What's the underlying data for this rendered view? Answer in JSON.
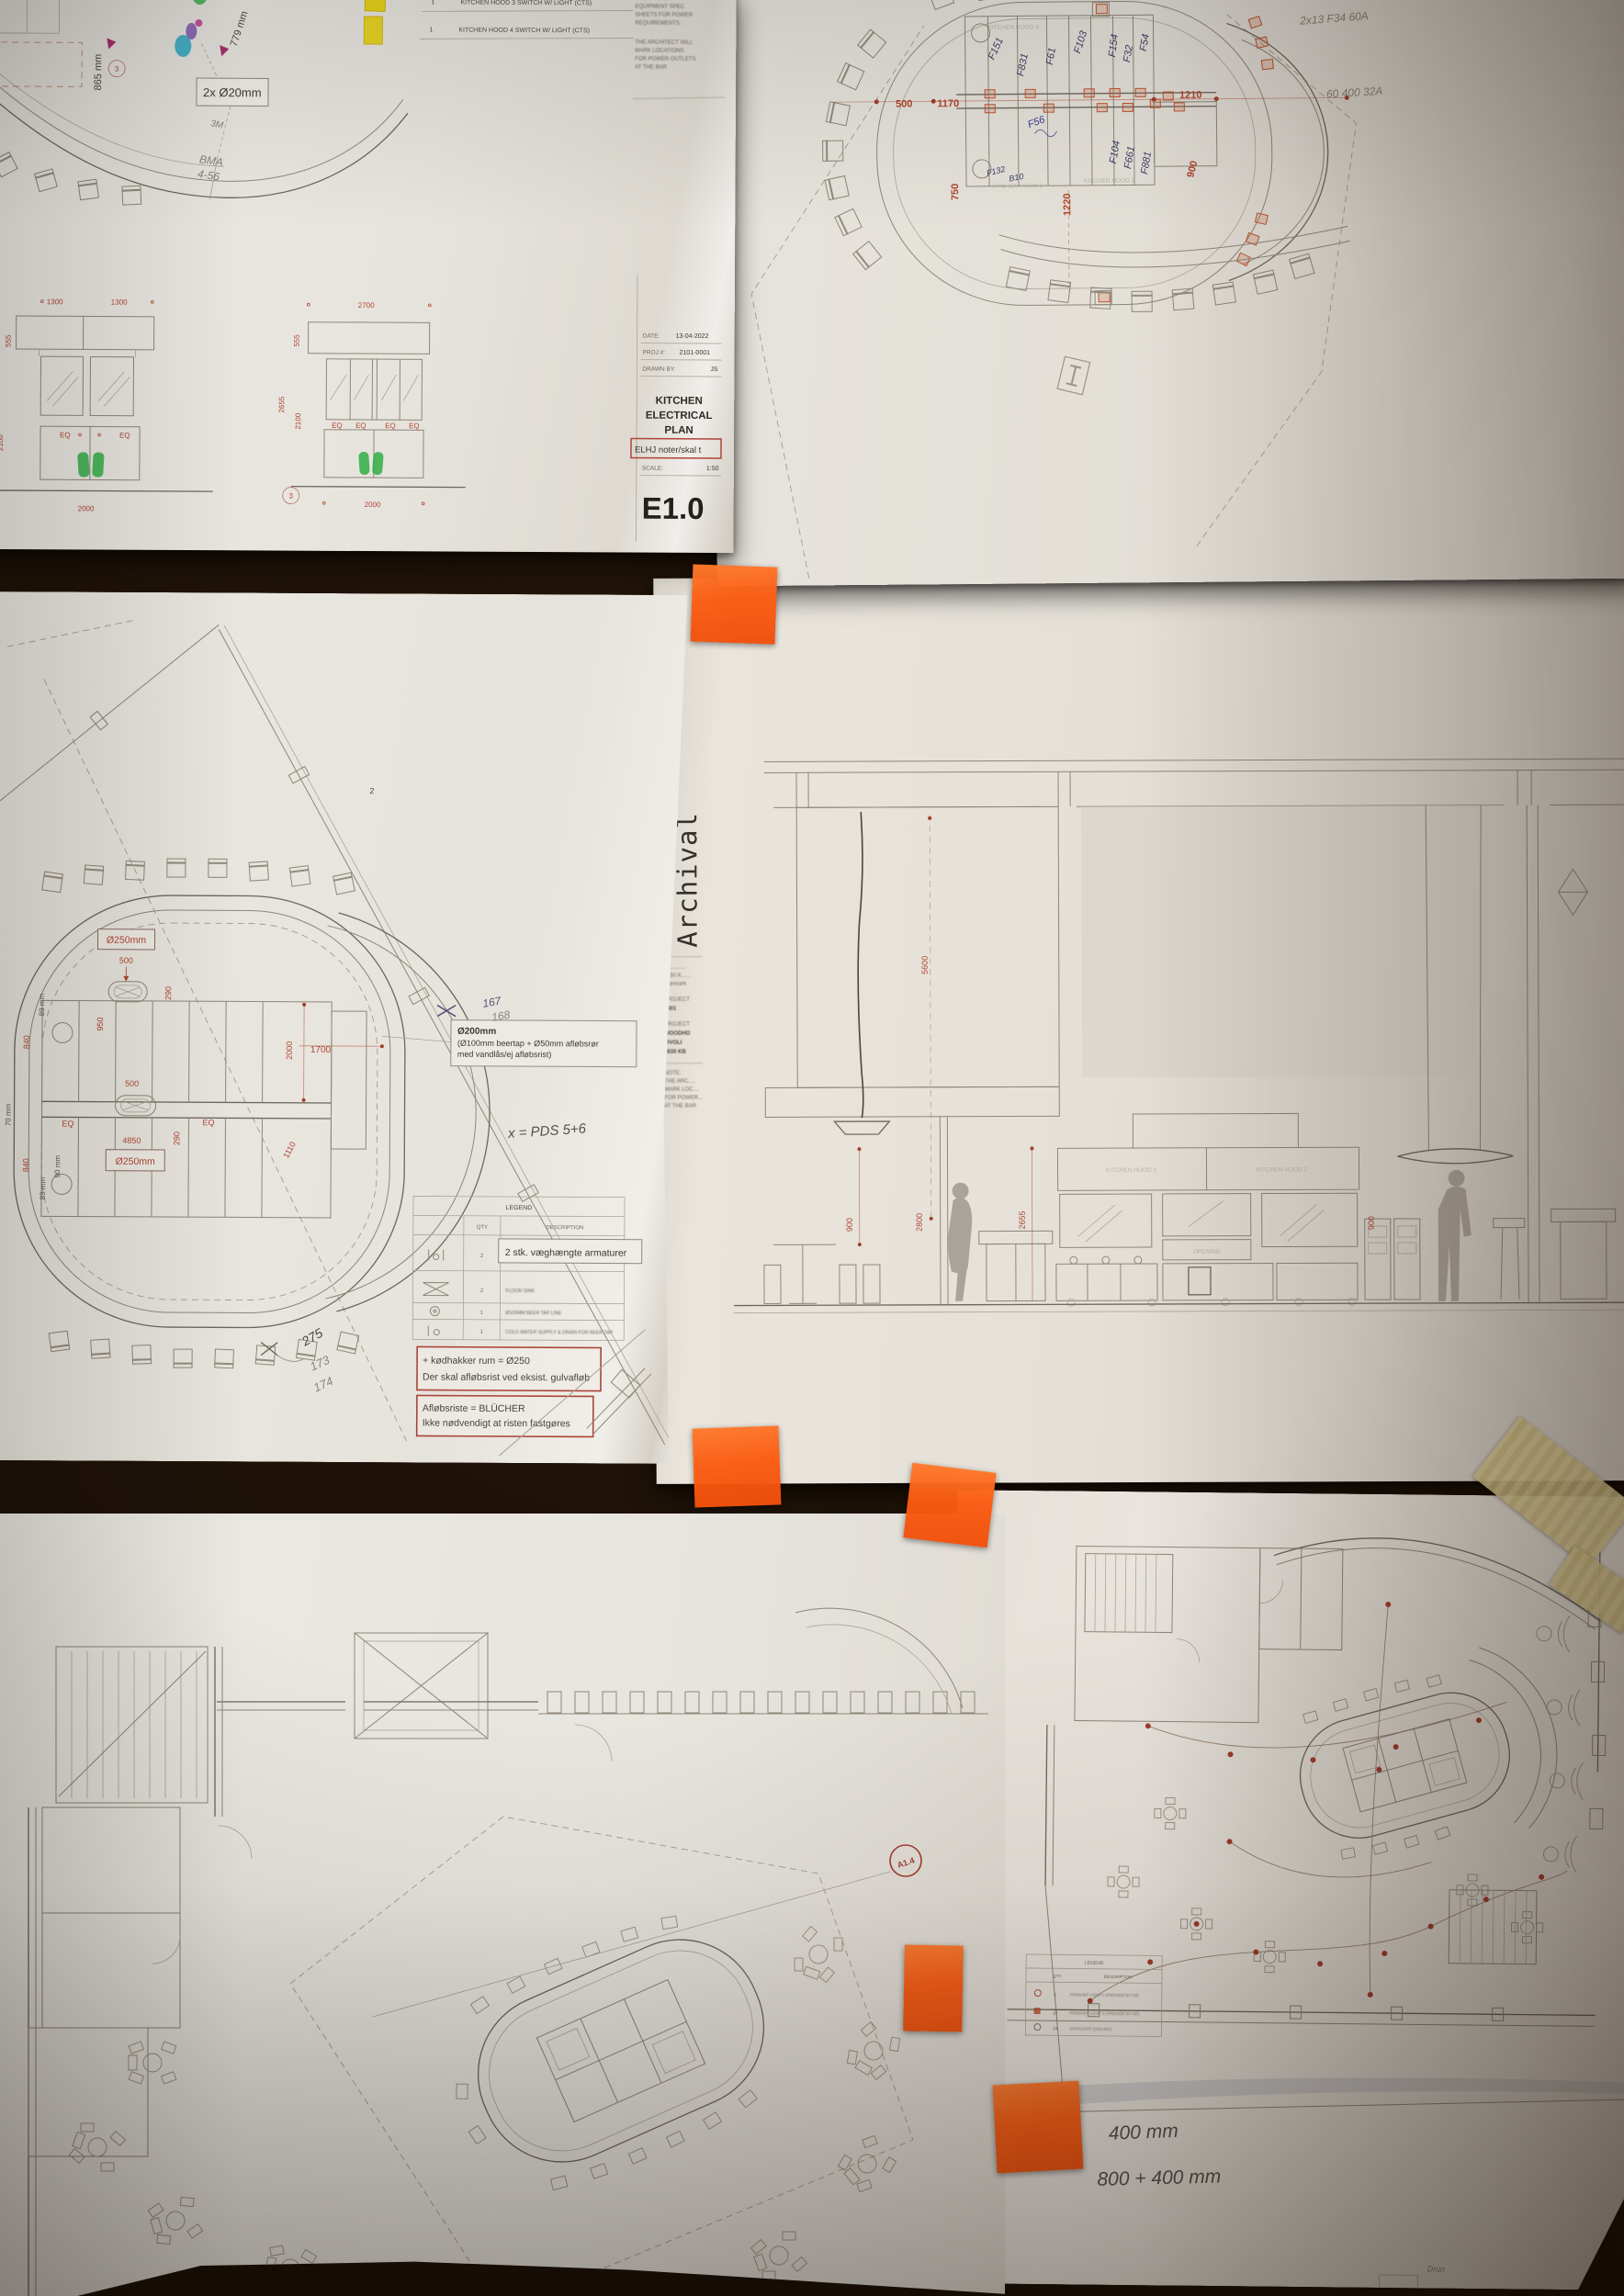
{
  "e10": {
    "dim_865": "865 mm",
    "dim_779": "779 mm",
    "conduit_label": "2x Ø20mm",
    "hw_3m": "3M",
    "hw_bma": "BMA",
    "hw_456": "4-56",
    "bubble_3": "3",
    "sched": {
      "r1_qty": "1",
      "r1_desc": "KITCHEN HOOD 3 SWITCH W/ LIGHT (CTS)",
      "r2_qty": "1",
      "r2_desc": "KITCHEN HOOD 4 SWITCH W/ LIGHT (CTS)"
    },
    "notes": [
      "THE KITCHEN",
      "EQUIPMENT SPEC",
      "SHEETS FOR POWER",
      "REQUIREMENTS.",
      "THE ARCHITECT WILL",
      "MARK LOCATIONS",
      "FOR POWER OUTLETS",
      "AT THE BAR"
    ],
    "elevL": {
      "top1": "1300",
      "top2": "1300",
      "side1": "555",
      "side2": "2100",
      "eq1": "EQ",
      "eq2": "EQ",
      "bottom": "2000"
    },
    "elevR": {
      "top": "2700",
      "side1": "555",
      "side2": "2655",
      "side3": "2100",
      "eq1": "EQ",
      "eq2": "EQ",
      "eq3": "EQ",
      "eq4": "EQ",
      "bottom": "2000",
      "bubble": "3"
    },
    "tb": {
      "date_l": "DATE:",
      "date": "13-04-2022",
      "proj_l": "PROJ #:",
      "proj": "2101-0001",
      "drawn_l": "DRAWN BY:",
      "drawn": "JS",
      "t1": "KITCHEN",
      "t2": "ELECTRICAL",
      "t3": "PLAN",
      "red_note": "ELHJ noter/skal t",
      "scale_l": "SCALE:",
      "scale": "1:50",
      "no": "E1.0"
    }
  },
  "elec": {
    "d500": "500",
    "d1170": "1170",
    "d1210": "1210",
    "d750": "750",
    "d1220": "1220",
    "d900": "900",
    "hood1": "KITCHEN HOOD 1",
    "hood2": "KITCHEN HOOD 2",
    "hood3": "KITCHEN HOOD 3",
    "c": {
      "f151": "F151",
      "f831": "F831",
      "f61": "F61",
      "f103": "F103",
      "f154": "F154",
      "f32": "F32",
      "f54": "F54",
      "f104": "F104",
      "f661": "F661",
      "f881": "F881",
      "f56": "F56",
      "f132": "F132",
      "b10": "B10"
    },
    "hw1": "2x13  F34  60A",
    "hw2": "60 400    32A"
  },
  "plumb": {
    "drain_top": "Ø250mm",
    "drain_bot": "Ø250mm",
    "d500a": "500",
    "d950": "950",
    "d840a": "840",
    "d840b": "840",
    "d89a": "89 mm",
    "d89b": "89 mm",
    "d90": "90 mm",
    "d70": "70 mm",
    "d290a": "290",
    "d290b": "290",
    "d500b": "500",
    "d4850": "4850",
    "d2000": "2000",
    "d1700": "1700",
    "d1110": "1110",
    "eq1": "EQ",
    "eq2": "EQ",
    "mark2": "2",
    "note_l1": "Ø200mm",
    "note_l2": "(Ø100mm beertap + Ø50mm afløbsrør",
    "note_l3": "med vandlås/ej afløbsrist)",
    "hw_167": "167",
    "hw_168": "168",
    "hw_pds": "x = PDS 5+6",
    "hw_275": "275",
    "hw_173": "173",
    "hw_174": "174",
    "legend": {
      "title": "LEGEND",
      "qty": "QTY",
      "desc": "DESCRIPTION",
      "rows": [
        {
          "qty": "2",
          "desc1": "COLD/HOT WATER SUPPLIES & DRAIN FOR",
          "desc2": "HANDSINK"
        },
        {
          "qty": "2",
          "desc1": "FLOOR SINK",
          "desc2": ""
        },
        {
          "qty": "1",
          "desc1": "Ø100MM BEER TAP LINE",
          "desc2": ""
        },
        {
          "qty": "1",
          "desc1": "COLD WATER SUPPLY & DRAIN FOR BEER TAP",
          "desc2": ""
        }
      ],
      "overlay": "2 stk. væghængte armaturer"
    },
    "red1a": "+ kødhakker rum = Ø250",
    "red1b": "Der skal afløbsrist ved eksist. gulvafløb",
    "red2a": "Afløbsriste = BLÜCHER",
    "red2b": "Ikke nødvendigt at risten fastgøres"
  },
  "section": {
    "margin": "Archival",
    "info": [
      "B............",
      "2450 K......",
      "Danmark",
      "PROJECT",
      "6601",
      "PROJECT",
      "WOODHO",
      "TIVOLI",
      "1630 KB",
      "NOTE:",
      "THE ARC.....",
      "MARK LOC....",
      "FOR POWER...",
      "AT THE BAR"
    ],
    "d5600": "5600",
    "d900L": "900",
    "d2800": "2800",
    "d2655": "2655",
    "d900R": "900",
    "hood1": "KITCHEN HOOD 1",
    "hood2": "KITCHEN HOOD 2",
    "opening": "OPENING"
  },
  "plan_a": {
    "bubble": "A1.4"
  },
  "plan_b": {
    "legend": {
      "title": "LEGEND",
      "qty": "QTY",
      "desc": "DESCRIPTION",
      "rows": [
        {
          "qty": "1",
          "desc": "PENDANT LIGHT L (PROVIDE BY KR)"
        },
        {
          "qty": "12",
          "desc": "PENDANT LIGHT S (PROVIDE BY KR)"
        },
        {
          "qty": "14",
          "desc": "SPOTLIGHT (CEILING)"
        }
      ]
    },
    "hw1": "400 mm",
    "hw2": "800 + 400 mm",
    "hw3": "Drun"
  }
}
